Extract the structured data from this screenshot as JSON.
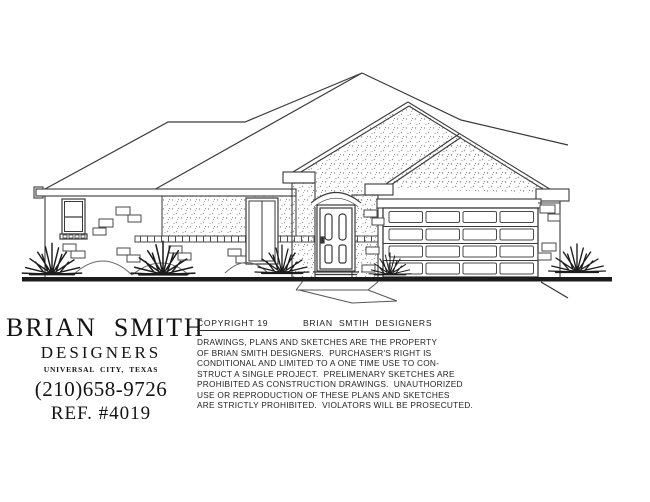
{
  "title_block": {
    "firm_name": "BRIAN  SMITH",
    "firm_sub": "DESIGNERS",
    "location": "UNIVERSAL  CITY,  TEXAS",
    "phone": "(210)658-9726",
    "reference": "REF. #4019"
  },
  "copyright": {
    "label": "COPYRIGHT 19",
    "owner": "BRIAN  SMTIH  DESIGNERS",
    "notice_lines": [
      "DRAWINGS, PLANS AND SKETCHES ARE THE PROPERTY",
      "OF BRIAN SMITH DESIGNERS.  PURCHASER'S RIGHT IS",
      "CONDITIONAL AND LIMITED TO A ONE TIME USE TO CON-",
      "STRUCT A SINGLE PROJECT.  PRELIMENARY SKETCHES ARE",
      "PROHIBITED AS CONSTRUCTION DRAWINGS.  UNAUTHORIZED",
      "USE OR REPRODUCTION OF THESE PLANS AND SKETCHES",
      "ARE STRICTLY PROHIBITED.  VIOLATORS WILL BE PROSECUTED."
    ]
  },
  "colors": {
    "ink": "#3a3a3a",
    "ground": "#141414",
    "stipple": "#8f8f8f",
    "paper": "#ffffff"
  }
}
